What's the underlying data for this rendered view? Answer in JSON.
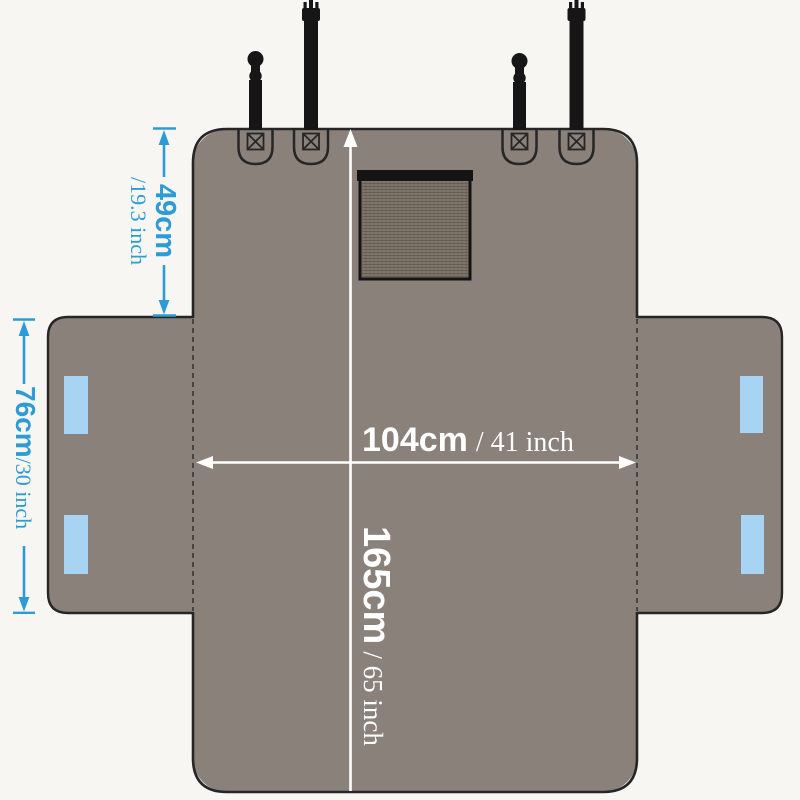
{
  "dimensions": {
    "width": {
      "value": "104cm",
      "alt_unit": "/ 41 inch"
    },
    "length": {
      "value": "165cm",
      "alt_unit": "/ 65 inch"
    },
    "back_flap": {
      "value": "49cm",
      "alt_unit": "/19.3 inch"
    },
    "side_flap": {
      "value": "76cm",
      "alt_unit": "/30 inch"
    }
  },
  "colors": {
    "background": "#f7f6f3",
    "cover_gray": "#8a817b",
    "outline_dark": "#262626",
    "fold_line": "#3b3b3b",
    "strap_black": "#161616",
    "mesh_fill": "#7f7569",
    "mesh_frame": "#141414",
    "dimension_blue": "#2e9cd4",
    "velcro_blue": "#a7d4f2",
    "dimension_white": "#ffffff"
  },
  "icons": {
    "clip_strap": "clip-strap-icon",
    "prong_strap": "prong-buckle-strap-icon",
    "stitch_box": "x-stitch-box-icon",
    "mesh_window": "mesh-window",
    "velcro_strip": "velcro-strip-icon"
  }
}
